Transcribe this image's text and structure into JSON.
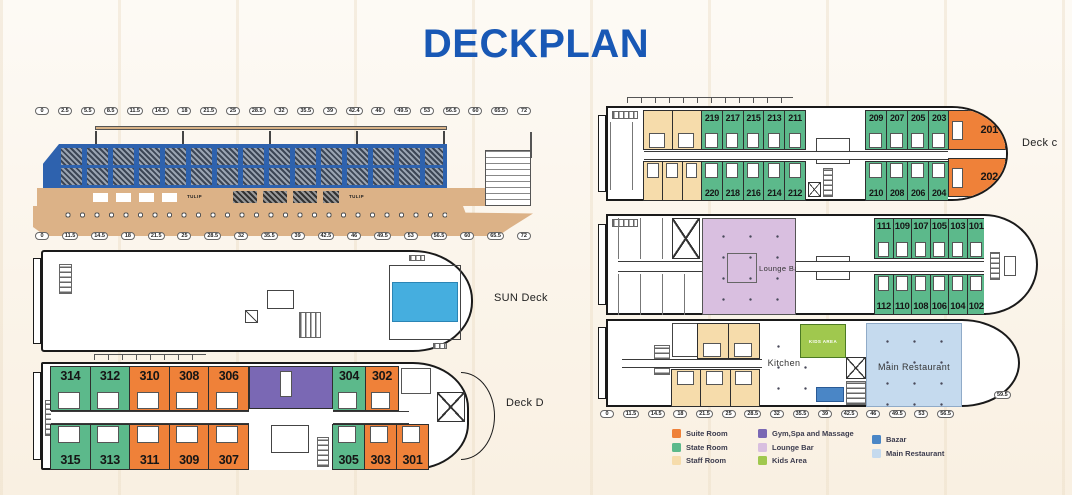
{
  "title": "DECKPLAN",
  "colors": {
    "suite": "#EF8139",
    "state": "#5CB98B",
    "staff": "#F6DCAB",
    "gym": "#7A68B4",
    "lounge": "#D9BFE0",
    "kids": "#A0C84E",
    "bazar": "#4A86C6",
    "restaurant": "#C5DAEE",
    "pool": "#45AEDF"
  },
  "legend": {
    "columns": [
      [
        {
          "label": "Suite Room",
          "type": "suite"
        },
        {
          "label": "State Room",
          "type": "state"
        },
        {
          "label": "Staff Room",
          "type": "staff"
        }
      ],
      [
        {
          "label": "Gym,Spa and Massage",
          "type": "gym"
        },
        {
          "label": "Lounge Bar",
          "type": "lounge"
        },
        {
          "label": "Kids Area",
          "type": "kids"
        }
      ],
      [
        {
          "label": "Bazar",
          "type": "bazar"
        },
        {
          "label": "Main Restaurant",
          "type": "restaurant"
        }
      ]
    ]
  },
  "side_view": {
    "brand": "TULIP",
    "top_scale": [
      "0",
      "2.5",
      "5.5",
      "8.5",
      "11.5",
      "14.5",
      "18",
      "21.5",
      "25",
      "28.5",
      "32",
      "35.5",
      "39",
      "42.4",
      "46",
      "49.5",
      "53",
      "56.5",
      "60",
      "65.5",
      "72"
    ],
    "bottom_scale": [
      "0",
      "11.5",
      "14.5",
      "18",
      "21.5",
      "25",
      "28.5",
      "32",
      "35.5",
      "39",
      "42.5",
      "46",
      "49.5",
      "53",
      "56.5",
      "60",
      "65.5",
      "72"
    ]
  },
  "sun_deck": {
    "label": "SUN Deck"
  },
  "deck_d": {
    "label": "Deck D",
    "rooms_top": [
      {
        "number": "314",
        "type": "state"
      },
      {
        "number": "312",
        "type": "state"
      },
      {
        "number": "310",
        "type": "suite"
      },
      {
        "number": "308",
        "type": "suite"
      },
      {
        "number": "306",
        "type": "suite"
      },
      {
        "number": "304",
        "type": "state"
      },
      {
        "number": "302",
        "type": "suite"
      }
    ],
    "rooms_bottom": [
      {
        "number": "315",
        "type": "state"
      },
      {
        "number": "313",
        "type": "state"
      },
      {
        "number": "311",
        "type": "suite"
      },
      {
        "number": "309",
        "type": "suite"
      },
      {
        "number": "307",
        "type": "suite"
      },
      {
        "number": "305",
        "type": "state"
      },
      {
        "number": "303",
        "type": "suite"
      },
      {
        "number": "301",
        "type": "suite"
      }
    ]
  },
  "deck_c": {
    "label": "Deck c",
    "staff_top": [
      {
        "type": "staff"
      },
      {
        "type": "staff"
      }
    ],
    "staff_bottom": [
      {
        "type": "staff"
      },
      {
        "type": "staff"
      },
      {
        "type": "staff"
      }
    ],
    "rooms_top": [
      {
        "number": "219",
        "type": "state"
      },
      {
        "number": "217",
        "type": "state"
      },
      {
        "number": "215",
        "type": "state"
      },
      {
        "number": "213",
        "type": "state"
      },
      {
        "number": "211",
        "type": "state"
      },
      {
        "number": "209",
        "type": "state"
      },
      {
        "number": "207",
        "type": "state"
      },
      {
        "number": "205",
        "type": "state"
      },
      {
        "number": "203",
        "type": "state"
      },
      {
        "number": "201",
        "type": "suite"
      }
    ],
    "rooms_bottom": [
      {
        "number": "220",
        "type": "state"
      },
      {
        "number": "218",
        "type": "state"
      },
      {
        "number": "216",
        "type": "state"
      },
      {
        "number": "214",
        "type": "state"
      },
      {
        "number": "212",
        "type": "state"
      },
      {
        "number": "210",
        "type": "state"
      },
      {
        "number": "208",
        "type": "state"
      },
      {
        "number": "206",
        "type": "state"
      },
      {
        "number": "204",
        "type": "state"
      },
      {
        "number": "202",
        "type": "suite"
      }
    ]
  },
  "deck_b": {
    "lounge_label": "Lounge Bar",
    "rooms_top": [
      {
        "number": "111",
        "type": "state"
      },
      {
        "number": "109",
        "type": "state"
      },
      {
        "number": "107",
        "type": "state"
      },
      {
        "number": "105",
        "type": "state"
      },
      {
        "number": "103",
        "type": "state"
      },
      {
        "number": "101",
        "type": "state"
      }
    ],
    "rooms_bottom": [
      {
        "number": "112",
        "type": "state"
      },
      {
        "number": "110",
        "type": "state"
      },
      {
        "number": "108",
        "type": "state"
      },
      {
        "number": "106",
        "type": "state"
      },
      {
        "number": "104",
        "type": "state"
      },
      {
        "number": "102",
        "type": "state"
      }
    ]
  },
  "deck_a": {
    "kitchen_label": "Kitchen",
    "kids_label": "KIDS AREA",
    "restaurant_label": "Main Restaurant",
    "bow_marker": "59.5",
    "staff_top": [
      {
        "type": "staff"
      },
      {
        "type": "staff"
      }
    ],
    "staff_bottom": [
      {
        "type": "staff"
      },
      {
        "type": "staff"
      },
      {
        "type": "staff"
      }
    ],
    "scale": [
      "0",
      "11.5",
      "14.5",
      "18",
      "21.5",
      "25",
      "28.5",
      "32",
      "35.5",
      "39",
      "42.5",
      "46",
      "49.5",
      "53",
      "56.5"
    ]
  }
}
